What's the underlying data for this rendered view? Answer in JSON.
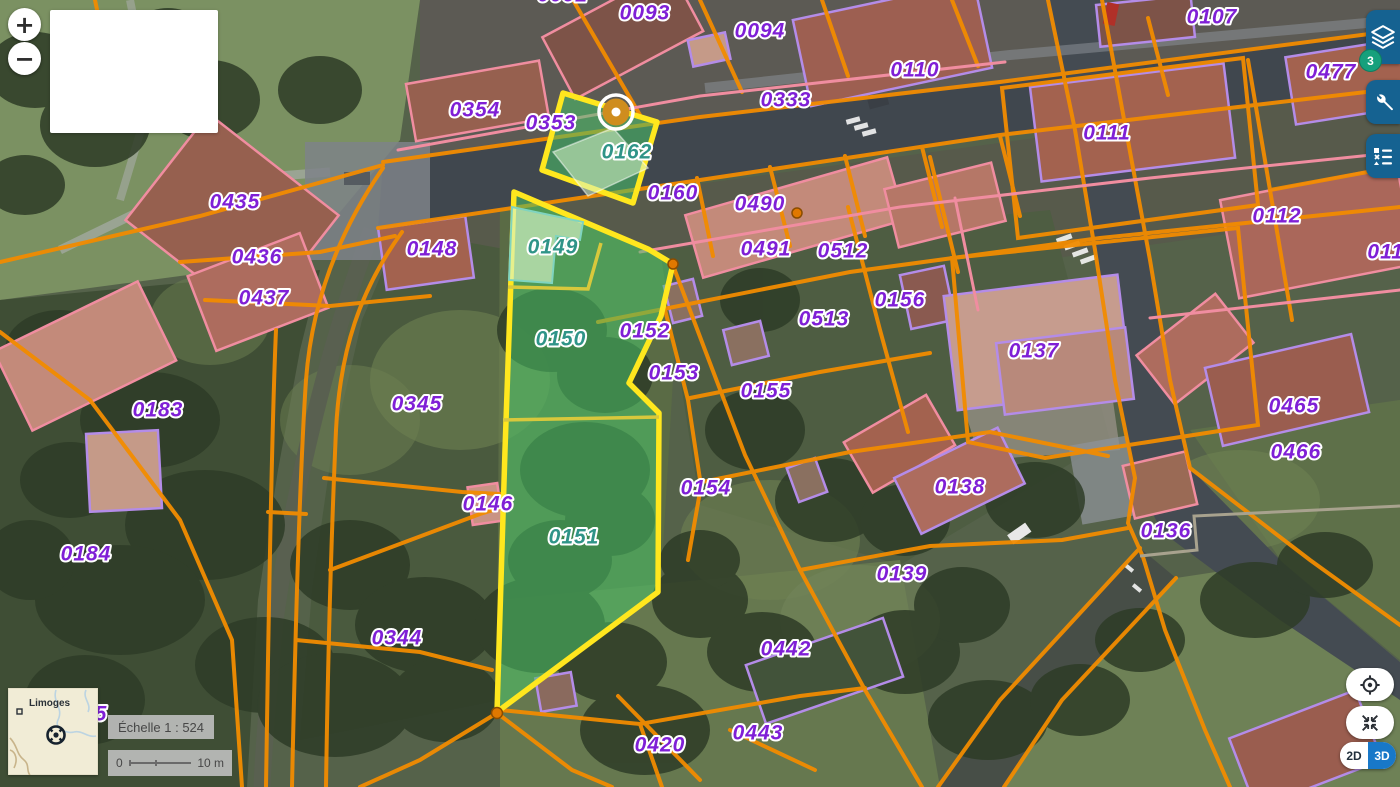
{
  "controls": {
    "zoom_in": "+",
    "zoom_out": "−"
  },
  "toolbar": {
    "layers_badge": "3",
    "icons": [
      "layers-icon",
      "wrench-icon",
      "legend-icon"
    ]
  },
  "view_controls": {
    "icons": [
      "geolocate-icon",
      "collapse-icon"
    ],
    "mode_2d": "2D",
    "mode_3d": "3D"
  },
  "minimap": {
    "city": "Limoges"
  },
  "scale": {
    "label": "Échelle 1 : 524",
    "bar_start": "0",
    "bar_end": "10 m"
  },
  "map": {
    "selected_parcels": [
      "0149",
      "0150",
      "0151",
      "0162"
    ],
    "colors": {
      "cadastre_line_orange": "#f28c00",
      "building_outline_pink": "#f08da0",
      "building_outline_purple": "#b48ce8",
      "selection_border_yellow": "#ffe71e",
      "selection_fill_green": "#49c268",
      "label_purple": "#7f1fd6",
      "label_selected_teal": "#2f9488",
      "button_blue": "#156291",
      "badge_green": "#16a07c",
      "toggle_blue": "#1878c8",
      "marker_amber": "#cf8d1e"
    },
    "parcel_labels": [
      {
        "text": "0092",
        "x": 563,
        "y": -5,
        "partial": true
      },
      {
        "text": "0093",
        "x": 645,
        "y": 13
      },
      {
        "text": "0094",
        "x": 760,
        "y": 31
      },
      {
        "text": "0110",
        "x": 915,
        "y": 70
      },
      {
        "text": "0107",
        "x": 1212,
        "y": 17
      },
      {
        "text": "0477",
        "x": 1331,
        "y": 72
      },
      {
        "text": "0333",
        "x": 786,
        "y": 100
      },
      {
        "text": "0111",
        "x": 1107,
        "y": 133
      },
      {
        "text": "0354",
        "x": 475,
        "y": 110
      },
      {
        "text": "0353",
        "x": 551,
        "y": 123
      },
      {
        "text": "0162",
        "x": 627,
        "y": 152,
        "selected": true
      },
      {
        "text": "0160",
        "x": 673,
        "y": 193
      },
      {
        "text": "0490",
        "x": 760,
        "y": 204
      },
      {
        "text": "0112",
        "x": 1277,
        "y": 216
      },
      {
        "text": "0435",
        "x": 235,
        "y": 202
      },
      {
        "text": "0148",
        "x": 432,
        "y": 249
      },
      {
        "text": "0149",
        "x": 553,
        "y": 247,
        "selected": true
      },
      {
        "text": "0491",
        "x": 766,
        "y": 249
      },
      {
        "text": "0512",
        "x": 843,
        "y": 251
      },
      {
        "text": "0113",
        "x": 1392,
        "y": 252,
        "partial": true
      },
      {
        "text": "0436",
        "x": 257,
        "y": 257
      },
      {
        "text": "0437",
        "x": 264,
        "y": 298
      },
      {
        "text": "0156",
        "x": 900,
        "y": 300
      },
      {
        "text": "0513",
        "x": 824,
        "y": 319
      },
      {
        "text": "0137",
        "x": 1034,
        "y": 351
      },
      {
        "text": "0150",
        "x": 561,
        "y": 339,
        "selected": true
      },
      {
        "text": "0152",
        "x": 645,
        "y": 331
      },
      {
        "text": "0153",
        "x": 674,
        "y": 373
      },
      {
        "text": "0155",
        "x": 766,
        "y": 391
      },
      {
        "text": "0183",
        "x": 158,
        "y": 410
      },
      {
        "text": "0345",
        "x": 417,
        "y": 404
      },
      {
        "text": "0465",
        "x": 1294,
        "y": 406
      },
      {
        "text": "0466",
        "x": 1296,
        "y": 452
      },
      {
        "text": "0154",
        "x": 706,
        "y": 488
      },
      {
        "text": "0146",
        "x": 488,
        "y": 504
      },
      {
        "text": "0138",
        "x": 960,
        "y": 487
      },
      {
        "text": "0136",
        "x": 1166,
        "y": 531
      },
      {
        "text": "0184",
        "x": 86,
        "y": 554
      },
      {
        "text": "0151",
        "x": 574,
        "y": 537,
        "selected": true
      },
      {
        "text": "0139",
        "x": 902,
        "y": 574
      },
      {
        "text": "0344",
        "x": 397,
        "y": 638
      },
      {
        "text": "0442",
        "x": 786,
        "y": 649
      },
      {
        "text": "0443",
        "x": 758,
        "y": 733
      },
      {
        "text": "0420",
        "x": 660,
        "y": 745
      },
      {
        "text": "5",
        "x": 101,
        "y": 714,
        "partial": true
      }
    ]
  }
}
